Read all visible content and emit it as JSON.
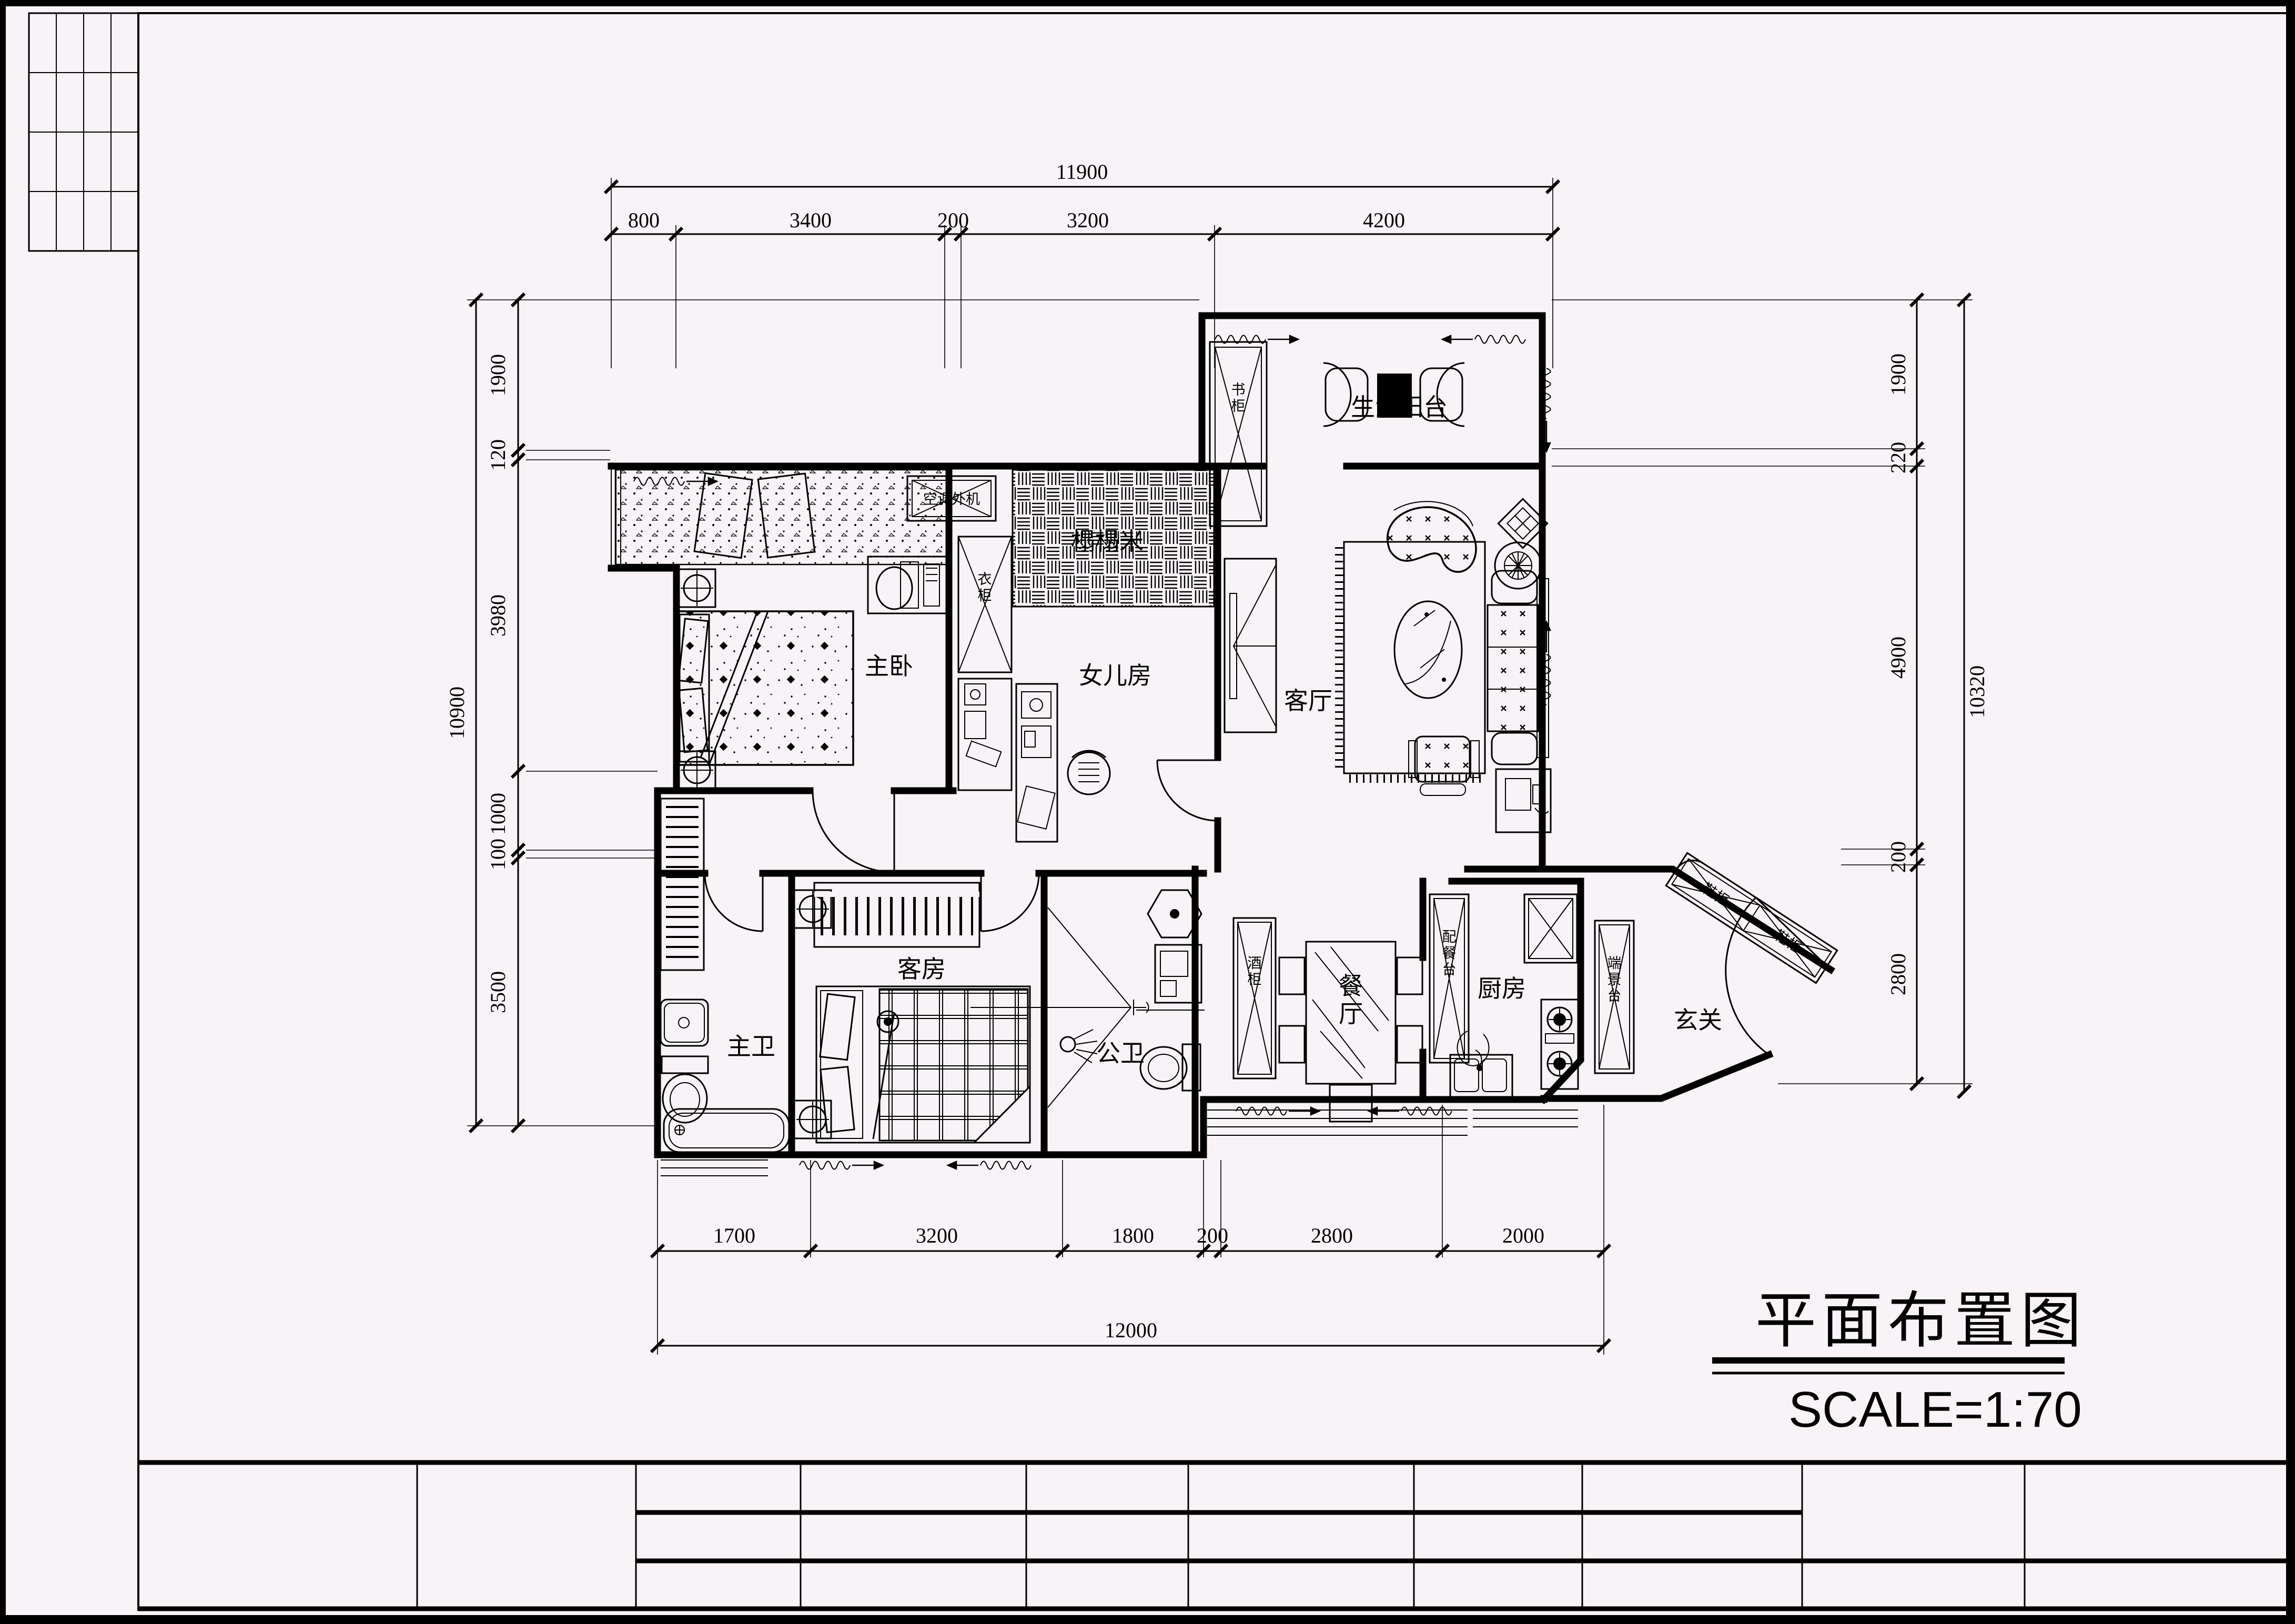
{
  "drawing": {
    "title": "平面布置图",
    "scale_label": "SCALE=1:70",
    "rooms": {
      "master_bedroom": "主卧",
      "daughter_room": "女儿房",
      "living_room": "客厅",
      "guest_room": "客房",
      "master_bath": "主卫",
      "public_bath": "公卫",
      "kitchen": "厨房",
      "dining_room": "餐厅",
      "entry": "玄关",
      "service_balcony": "生活阳台",
      "tatami": "榻榻米"
    },
    "fixtures": {
      "ac_unit": "空调外机",
      "bookcase": "书柜",
      "wardrobe": "衣柜",
      "wine_cabinet": "酒柜",
      "serving_counter": "配餐台",
      "console_table": "端景台",
      "shoe_cabinet": "鞋柜"
    },
    "dimensions": {
      "top": {
        "overall": "11900",
        "segments": [
          "800",
          "3400",
          "200",
          "3200",
          "4200"
        ]
      },
      "bottom": {
        "overall": "12000",
        "segments": [
          "1700",
          "3200",
          "1800",
          "200",
          "2800",
          "2000"
        ]
      },
      "left": {
        "overall": "10900",
        "segments": [
          "1900",
          "120",
          "3980",
          "1000",
          "100",
          "3500"
        ]
      },
      "right": {
        "overall": "10320",
        "segments": [
          "1900",
          "220",
          "4900",
          "200",
          "2800"
        ]
      }
    }
  }
}
